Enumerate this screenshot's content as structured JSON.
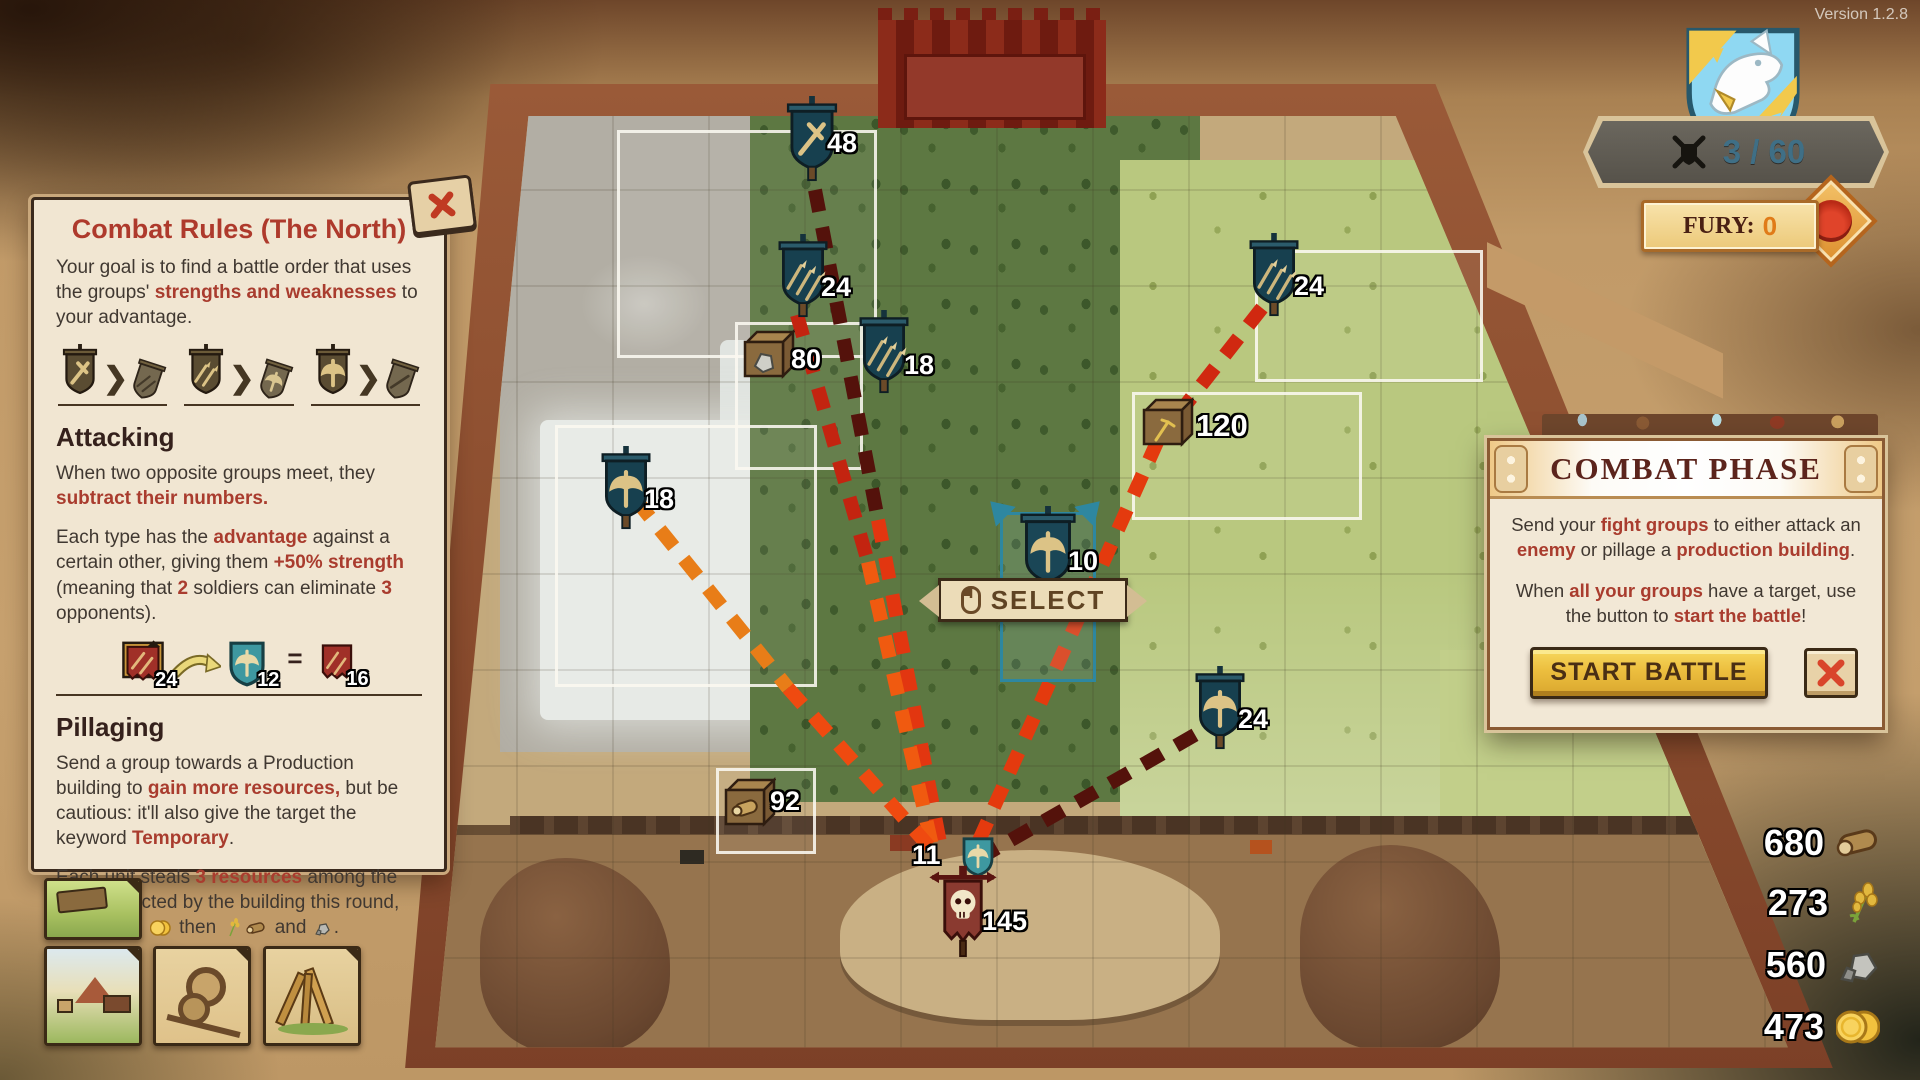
{
  "version": "Version 1.2.8",
  "hud": {
    "progress_value": "3 / 60",
    "fury_label": "FURY:",
    "fury_value": "0",
    "icons": {
      "emblem": "wolf-shield",
      "progress": "crossed-swords-shield",
      "fury": "dragon-diamond"
    }
  },
  "rules_panel": {
    "title": "Combat Rules (The North)",
    "intro": [
      "Your goal is to find a battle order that uses the groups' ",
      "strengths and weaknesses",
      " to your advantage."
    ],
    "advantage_chevron": "❯",
    "advantage_pairs": [
      {
        "winner": "sword",
        "loser": "arrows"
      },
      {
        "winner": "arrows",
        "loser": "axe"
      },
      {
        "winner": "axe",
        "loser": "sword"
      }
    ],
    "attacking_heading": "Attacking",
    "attack_p1": [
      "When two opposite groups meet, they ",
      "subtract their numbers."
    ],
    "attack_p2": [
      "Each type has the ",
      "advantage",
      " against a certain other, giving them ",
      "+50% strength",
      " (meaning that ",
      "2",
      " soldiers can eliminate ",
      "3",
      " opponents)."
    ],
    "example": {
      "attacker": "24",
      "defender": "12",
      "result": "16",
      "equals": "="
    },
    "pillaging_heading": "Pillaging",
    "pillage_p1": [
      "Send a group towards a Production building to ",
      "gain more resources,",
      " but be cautious: it'll also give the target the keyword ",
      "Temporary",
      "."
    ],
    "pillage_p2": [
      "Each unit steals ",
      "3 resources",
      " among the ones collected by the building this round, prioritising ",
      " then ",
      " and ",
      "."
    ]
  },
  "combat_panel": {
    "title": "COMBAT PHASE",
    "p1": [
      "Send your ",
      "fight groups",
      " to either attack an ",
      "enemy",
      " or pillage a ",
      "production building",
      "."
    ],
    "p2": [
      "When ",
      "all your groups",
      " have a target, use the button to ",
      "start the battle",
      "!"
    ],
    "start_button": "START BATTLE"
  },
  "map": {
    "select_label": "SELECT",
    "units": {
      "sword_48": "48",
      "arrows_24_top": "24",
      "crate_stone_80": "80",
      "arrows_18": "18",
      "axe_18": "18",
      "crate_wheat_120": "120",
      "axe_10_selected": "10",
      "arrows_24_right": "24",
      "axe_24_right": "24",
      "crate_wood_92": "92",
      "incoming_axe_11": "11",
      "enemy_skull_145": "145"
    }
  },
  "resources": [
    {
      "name": "wood",
      "value": "680"
    },
    {
      "name": "wheat",
      "value": "273"
    },
    {
      "name": "stone",
      "value": "560"
    },
    {
      "name": "gold",
      "value": "473"
    }
  ],
  "colors": {
    "panel_bg": "#f1e6d2",
    "title_red": "#ae3a2c",
    "em_red": "#a93c2e",
    "gold_button": "#ecbe3e",
    "fury_orange": "#e07b18",
    "progress_blue": "#3f6f86",
    "attack_line_dark": "#54120b",
    "attack_line_bright": "#e8420f"
  }
}
